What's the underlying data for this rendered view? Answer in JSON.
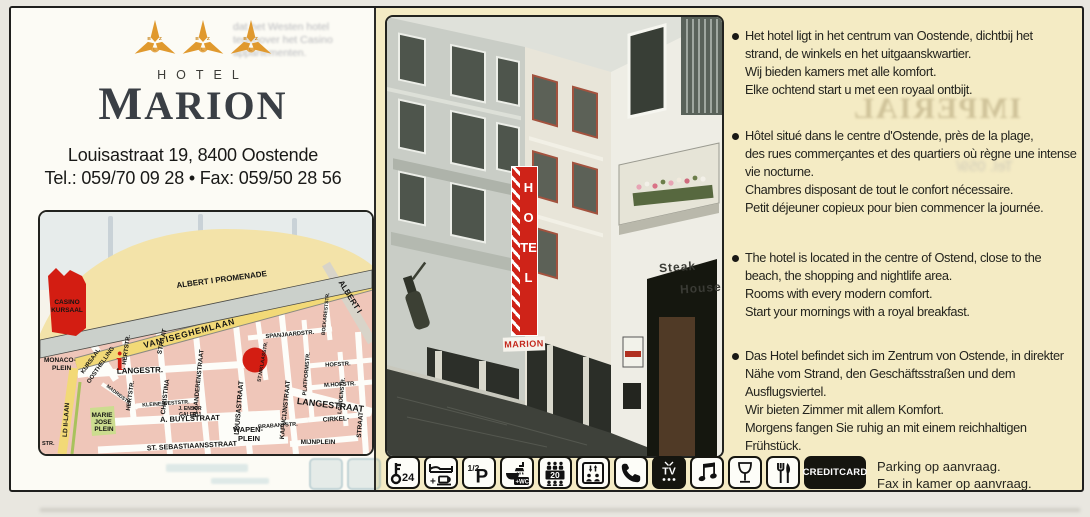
{
  "colors": {
    "accent_red": "#d31d12",
    "logo_gold": "#e0992e",
    "panel_yellow": "#f4ebc4",
    "panel_white": "#fcfbf5",
    "map_pink": "#efc6b9",
    "map_road_yellow": "#f2d977"
  },
  "brand": {
    "hotel_label": "HOTEL",
    "name": "MARION",
    "stars_count": 3,
    "star_letters": [
      "B",
      "Z",
      "L"
    ]
  },
  "contact": {
    "address": "Louisastraat 19, 8400 Oostende",
    "tel_fax": "Tel.: 059/70 09 28 • Fax: 059/50 28 56"
  },
  "map": {
    "info_marker": "i",
    "labels": {
      "promenade": "ALBERT I PROMENADE",
      "albert1": "ALBERT I",
      "kursaal_a": "KURSAAL",
      "kursaal_b": "OOSTHELLING",
      "casino_1": "CASINO",
      "casino_2": "KURSAAL",
      "monaco_1": "MONACO-",
      "monaco_2": "PLEIN",
      "hert_1": "HERTSTR.",
      "hert_2": "HERTSTR.",
      "christina_top": "STRAAT",
      "christina": "CHRISTINA",
      "iseghem": "VAN ISEGHEMLAAN",
      "spanjaard": "SPANJAARDSTR.",
      "vlaanderen": "VLAANDERENSTRAAT",
      "louisa": "LOUISASTRAAT",
      "niklaas": "ST.NIKLAASSTR.",
      "kapucijn": "KAPUCIJNSTRAAT",
      "platform": "PLATFORMSTR.",
      "hof": "HOFSTR.",
      "mhof": "M.HOFSTR.",
      "boekarest": "BOEKARESTSTR.",
      "londen": "LONDENSTR.",
      "langestr": "LANGESTR.",
      "langestraat_r": "LANGESTRAAT",
      "kleine": "KLEINE WESTSTR.",
      "ensor_1": "J. ENSOR",
      "ensor_2": "GALERIJ",
      "madrid": "MADRIDSTR.",
      "buyl": "A. BUYLSTRAAT",
      "marie_1": "MARIE",
      "marie_2": "JOSE",
      "marie_3": "PLEIN",
      "leopold": "LD II-LAAN",
      "sebastiaan": "ST. SEBASTIAANSSTRAAT",
      "wapen_1": "WAPEN-",
      "wapen_2": "PLEIN",
      "brabant": "BRABANTSTR.",
      "cirkel": "CIRKEL-",
      "straat_r": "STRAAT",
      "mijn": "MIJNPLEIN",
      "str_bl": "STR."
    }
  },
  "photo": {
    "sign_hotel": "HOTEL",
    "sign_marion": "MARION",
    "steak_line1": "Steak",
    "steak_line2": "House"
  },
  "descriptions": [
    {
      "lang": "nl",
      "lines": [
        "Het hotel ligt in het centrum van Oostende, dichtbij het",
        "strand, de winkels en het uitgaanskwartier.",
        "Wij bieden kamers met alle komfort.",
        "Elke ochtend start u met een royaal ontbijt."
      ]
    },
    {
      "lang": "fr",
      "lines": [
        "Hôtel situé dans le centre d'Ostende, près de la plage,",
        "des rues commerçantes et des quartiers où règne une intense",
        "vie nocturne.",
        "Chambres disposant de tout le confort nécessaire.",
        "Petit déjeuner copieux pour bien commencer la journée."
      ]
    },
    {
      "lang": "en",
      "lines": [
        "The hotel is located in the centre of Ostend, close to the",
        "beach, the shopping and nightlife area.",
        "Rooms with every modern comfort.",
        "Start your mornings with a royal breakfast."
      ]
    },
    {
      "lang": "de",
      "lines": [
        "Das Hotel befindet sich im Zentrum von Ostende, in direkter",
        "Nähe vom Strand, den Geschäftsstraßen und dem",
        "Ausflugsviertel.",
        "Wir bieten Zimmer mit allem Komfort.",
        "Morgens fangen Sie ruhig an mit einem reichhaltigen",
        "Frühstück."
      ]
    }
  ],
  "amenities": {
    "key_hours": "24",
    "bed_plus": "+",
    "half_pension_fraction": "1/2",
    "half_pension_p": "P",
    "wc_label": "+WC",
    "rooms_count": "20",
    "tv_label": "TV",
    "creditcard_label": "CREDITCARD",
    "notes": [
      "Parking op aanvraag.",
      "Fax in kamer op aanvraag."
    ]
  },
  "ghost": {
    "imperial": "IMPERIAL",
    "tel_fragment": "Tel. 059/",
    "left_lines": [
      "dat het Westen hotel",
      "tegenover het Casino",
      "appartementen."
    ]
  }
}
